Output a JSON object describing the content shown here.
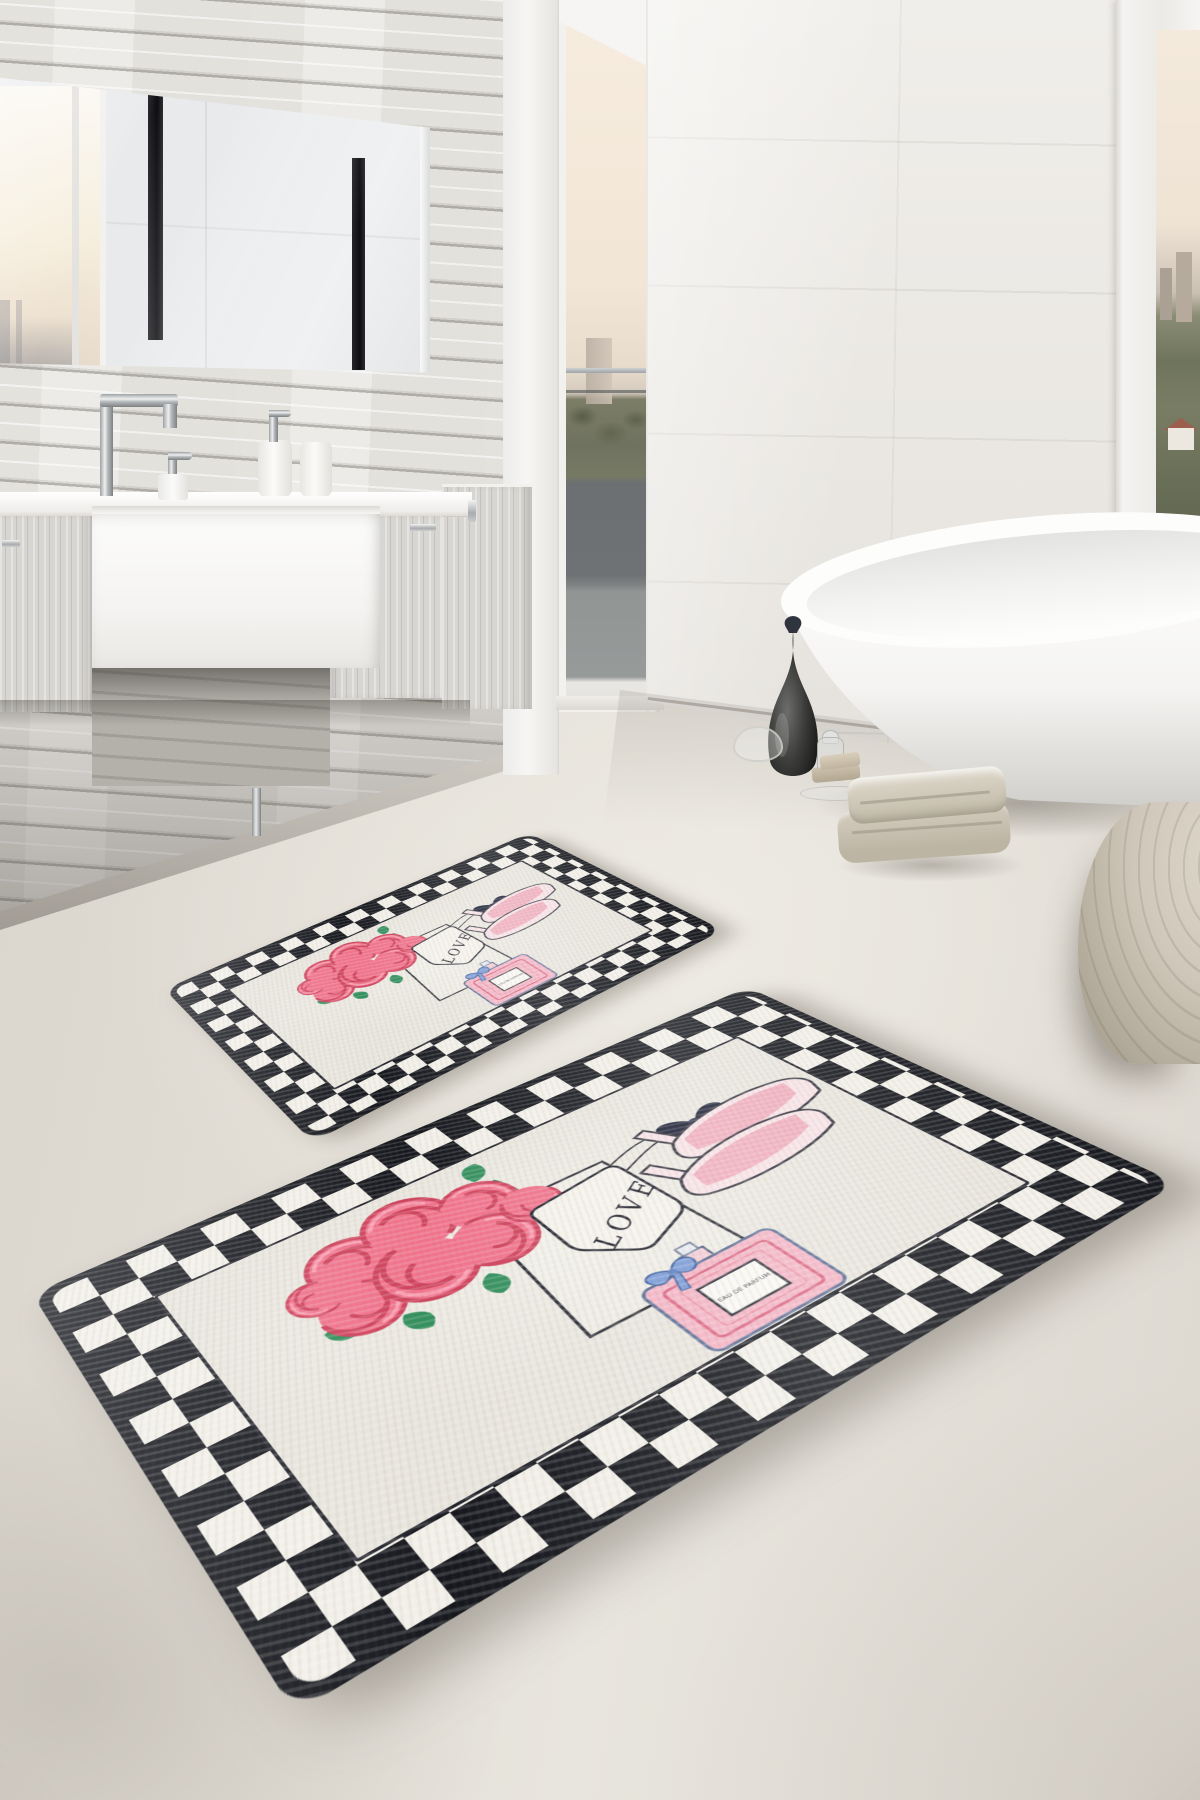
{
  "mats": {
    "large": {
      "tag_text": "LOVE",
      "perfume_label": "EAU DE PARFUM"
    },
    "small": {
      "tag_text": "LOVE",
      "perfume_label": "EAU DE PARFUM"
    }
  },
  "palette": {
    "floor": "#e0dcd4",
    "plank_wall": "#e9e7e3",
    "tile_wall": "#eeece8",
    "mat_field": "#e9e6de",
    "checker_black": "#16181e",
    "checker_white": "#f3f0e9",
    "rose_pink": "#f2758e",
    "rose_deep": "#d0455f",
    "leaf_green": "#35915f",
    "perfume_pink": "#f5b6c6",
    "ribbon_navy": "#191d33",
    "bow_blue": "#7b9cd8",
    "heel_pink": "#f1aebe",
    "towel_beige": "#cfc8ba",
    "pouf_beige": "#c4bcae",
    "tub_white": "#fbfbfa",
    "vase_black": "#2a2a2a"
  }
}
